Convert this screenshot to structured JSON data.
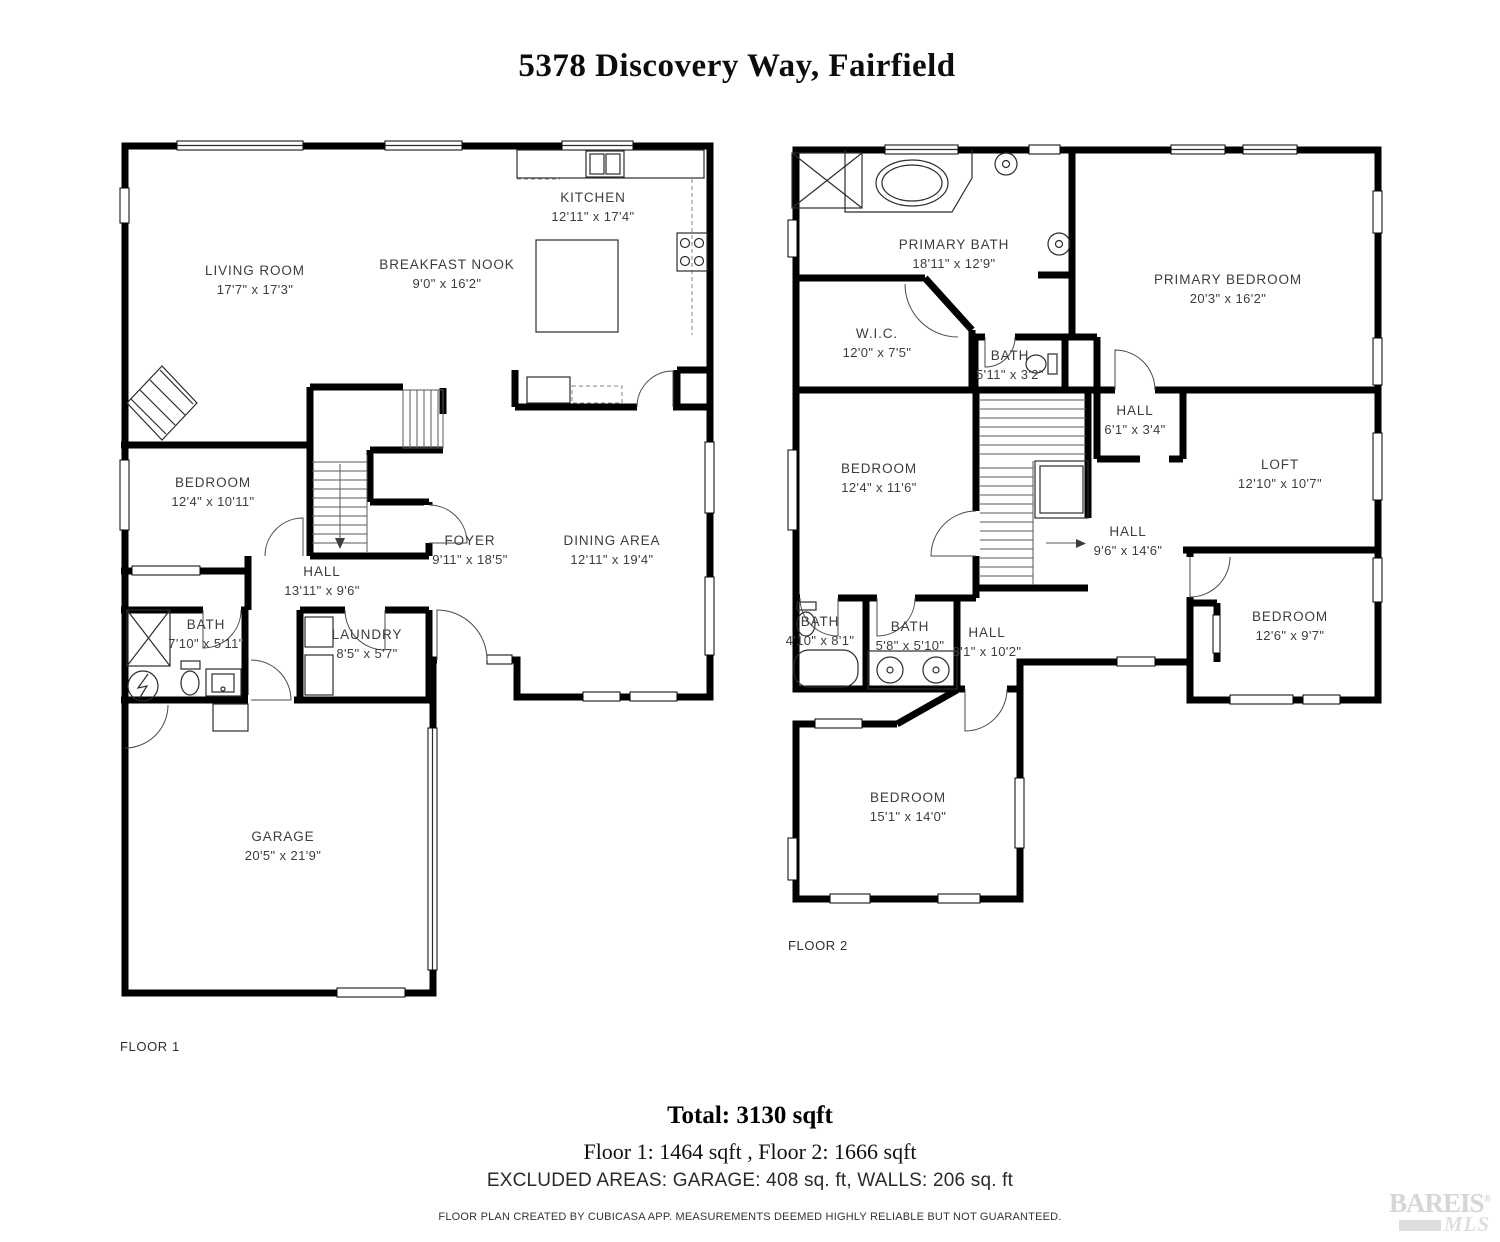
{
  "title": "5378 Discovery Way, Fairfield",
  "floors": [
    {
      "label": "FLOOR 1",
      "rooms": [
        {
          "name": "LIVING ROOM",
          "dims": "17'7\" x 17'3\""
        },
        {
          "name": "BREAKFAST NOOK",
          "dims": "9'0\" x 16'2\""
        },
        {
          "name": "KITCHEN",
          "dims": "12'11\" x 17'4\""
        },
        {
          "name": "BEDROOM",
          "dims": "12'4\" x 10'11\""
        },
        {
          "name": "HALL",
          "dims": "13'11\" x 9'6\""
        },
        {
          "name": "FOYER",
          "dims": "9'11\" x 18'5\""
        },
        {
          "name": "DINING AREA",
          "dims": "12'11\" x 19'4\""
        },
        {
          "name": "BATH",
          "dims": "7'10\" x 5'11\""
        },
        {
          "name": "LAUNDRY",
          "dims": "8'5\" x 5'7\""
        },
        {
          "name": "GARAGE",
          "dims": "20'5\" x 21'9\""
        }
      ]
    },
    {
      "label": "FLOOR 2",
      "rooms": [
        {
          "name": "PRIMARY BATH",
          "dims": "18'11\" x 12'9\""
        },
        {
          "name": "PRIMARY BEDROOM",
          "dims": "20'3\" x 16'2\""
        },
        {
          "name": "W.I.C.",
          "dims": "12'0\" x 7'5\""
        },
        {
          "name": "BATH",
          "dims": "5'11\" x 3'2\""
        },
        {
          "name": "HALL",
          "dims": "6'1\" x 3'4\""
        },
        {
          "name": "BEDROOM",
          "dims": "12'4\" x 11'6\""
        },
        {
          "name": "LOFT",
          "dims": "12'10\" x 10'7\""
        },
        {
          "name": "HALL",
          "dims": "9'6\" x 14'6\""
        },
        {
          "name": "BATH",
          "dims": "4'10\" x 8'1\""
        },
        {
          "name": "BATH",
          "dims": "5'8\" x 5'10\""
        },
        {
          "name": "HALL",
          "dims": "8'1\" x 10'2\""
        },
        {
          "name": "BEDROOM",
          "dims": "12'6\" x 9'7\""
        },
        {
          "name": "BEDROOM",
          "dims": "15'1\" x 14'0\""
        }
      ]
    }
  ],
  "summary": {
    "total": "Total: 3130 sqft",
    "floors_line": "Floor 1: 1464 sqft , Floor 2: 1666 sqft",
    "excluded": "EXCLUDED AREAS: GARAGE: 408 sq. ft, WALLS: 206 sq. ft",
    "attribution": "FLOOR PLAN CREATED BY CUBICASA APP. MEASUREMENTS DEEMED HIGHLY RELIABLE BUT NOT GUARANTEED."
  },
  "logo": {
    "line1": "BAREIS",
    "reg": "®",
    "line2": "MLS"
  },
  "colors": {
    "walls": "#000000",
    "label": "#3d3d3d",
    "logo": "#d6d6d6"
  }
}
